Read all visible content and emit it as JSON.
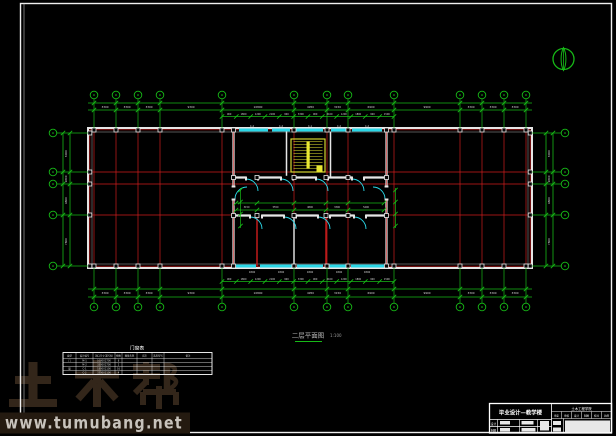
{
  "colors": {
    "grid_green": "#17b917",
    "axis_red": "#cf1d1d",
    "wall_white": "#e6e6e6",
    "wall_inner": "#8f8f8f",
    "window_cyan": "#2ad8e8",
    "stair_yellow": "#e8e832",
    "dim_text": "#d8d8d8",
    "label_gray": "#b5b5b5",
    "frame": "#efefef",
    "table_line": "#ffffff",
    "watermark_brown": "#33261a",
    "band_bg": "#241a10",
    "band_text": "#c8c3bc"
  },
  "plan": {
    "cols": [
      94,
      116,
      138,
      160,
      222,
      294,
      327,
      348,
      394,
      460,
      482,
      504,
      526
    ],
    "rows": [
      133,
      172,
      184,
      215,
      266
    ],
    "building": {
      "x1": 88,
      "y1": 128,
      "x2": 532,
      "y2": 268
    },
    "dims_h": [
      "3300",
      "3300",
      "3300",
      "9300",
      "10800",
      "4950",
      "3150",
      "6900",
      "9900",
      "3300",
      "3300",
      "3300"
    ],
    "dims_v": [
      "6000",
      "1800",
      "4800",
      "7800"
    ],
    "dims_dense": [
      "900",
      "1800",
      "1200",
      "2100",
      "900",
      "3300",
      "900",
      "2100",
      "1200",
      "1800",
      "900",
      "1500"
    ],
    "dims_corridor": [
      "3150",
      "5550",
      "4800",
      "3300",
      "5400"
    ],
    "window_labels": [
      "C-2",
      "C-2",
      "C-1",
      "C-2",
      "C-2"
    ],
    "sill_labels": [
      "1800",
      "1800",
      "1800",
      "1800",
      "1800"
    ]
  },
  "annotation": {
    "title": "二层平面图",
    "scale": "1:100"
  },
  "schedule": {
    "title": "门窗表",
    "headers": [
      "类型",
      "设计编号",
      "洞口尺寸(宽X高)",
      "樘数",
      "图集名称",
      "页次",
      "选用型号",
      "备注"
    ],
    "rows": [
      [
        "门",
        "M-1",
        "1000X2700",
        "8",
        "",
        "",
        "",
        ""
      ],
      [
        "",
        "M-2",
        "3300X2700",
        "2",
        "",
        "",
        "",
        ""
      ],
      [
        "窗",
        "C-1",
        "1800X2100",
        "16",
        "",
        "",
        "",
        ""
      ],
      [
        "",
        "C-2",
        "3300X2100",
        "4",
        "",
        "",
        "",
        ""
      ]
    ]
  },
  "title_block": {
    "project": "毕业设计—教学楼",
    "org": "土木工程学院",
    "cells": [
      "审定",
      "审核",
      "设计",
      "制图",
      "校对",
      "比例"
    ],
    "left_row1": "设计",
    "left_row2": "制图"
  },
  "watermark": {
    "brand": "土木帮",
    "url": "www.tumubang.net"
  }
}
